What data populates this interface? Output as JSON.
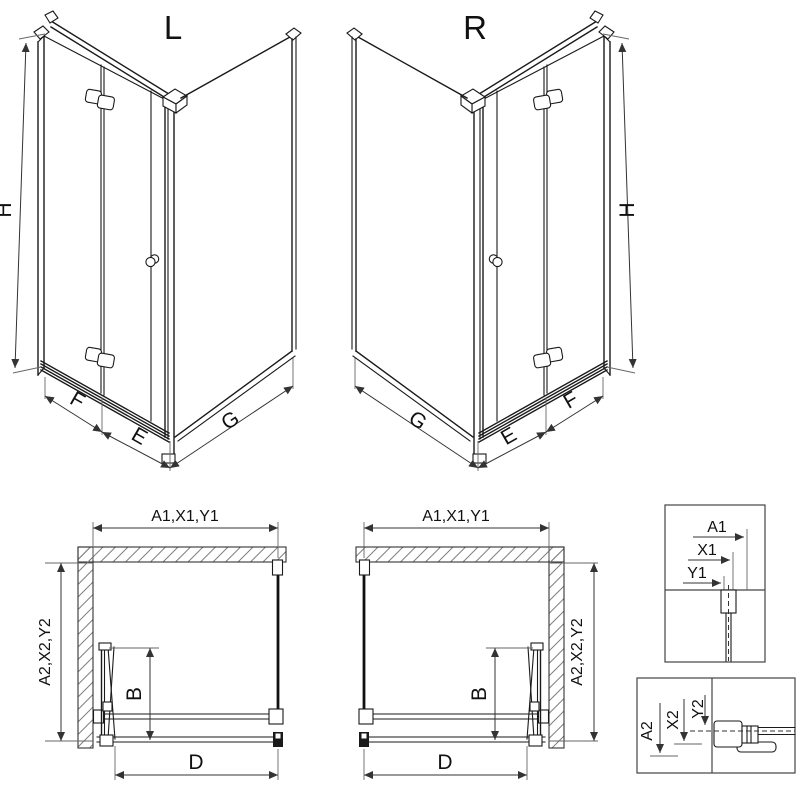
{
  "views": {
    "left3d": {
      "label": "L",
      "dim_h": "H",
      "dim_f": "F",
      "dim_e": "E",
      "dim_g": "G"
    },
    "right3d": {
      "label": "R",
      "dim_h": "H",
      "dim_f": "F",
      "dim_e": "E",
      "dim_g": "G"
    },
    "planLeft": {
      "dim_top": "A1,X1,Y1",
      "dim_side": "A2,X2,Y2",
      "dim_b": "B",
      "dim_d": "D"
    },
    "planRight": {
      "dim_top": "A1,X1,Y1",
      "dim_side": "A2,X2,Y2",
      "dim_b": "B",
      "dim_d": "D"
    },
    "detailTop": {
      "dim_a": "A1",
      "dim_x": "X1",
      "dim_y": "Y1"
    },
    "detailBottom": {
      "dim_a": "A2",
      "dim_x": "X2",
      "dim_y": "Y2"
    }
  },
  "colors": {
    "line": "#1a1a1a",
    "dim": "#333333",
    "hatch": "#808080",
    "background": "#ffffff"
  }
}
